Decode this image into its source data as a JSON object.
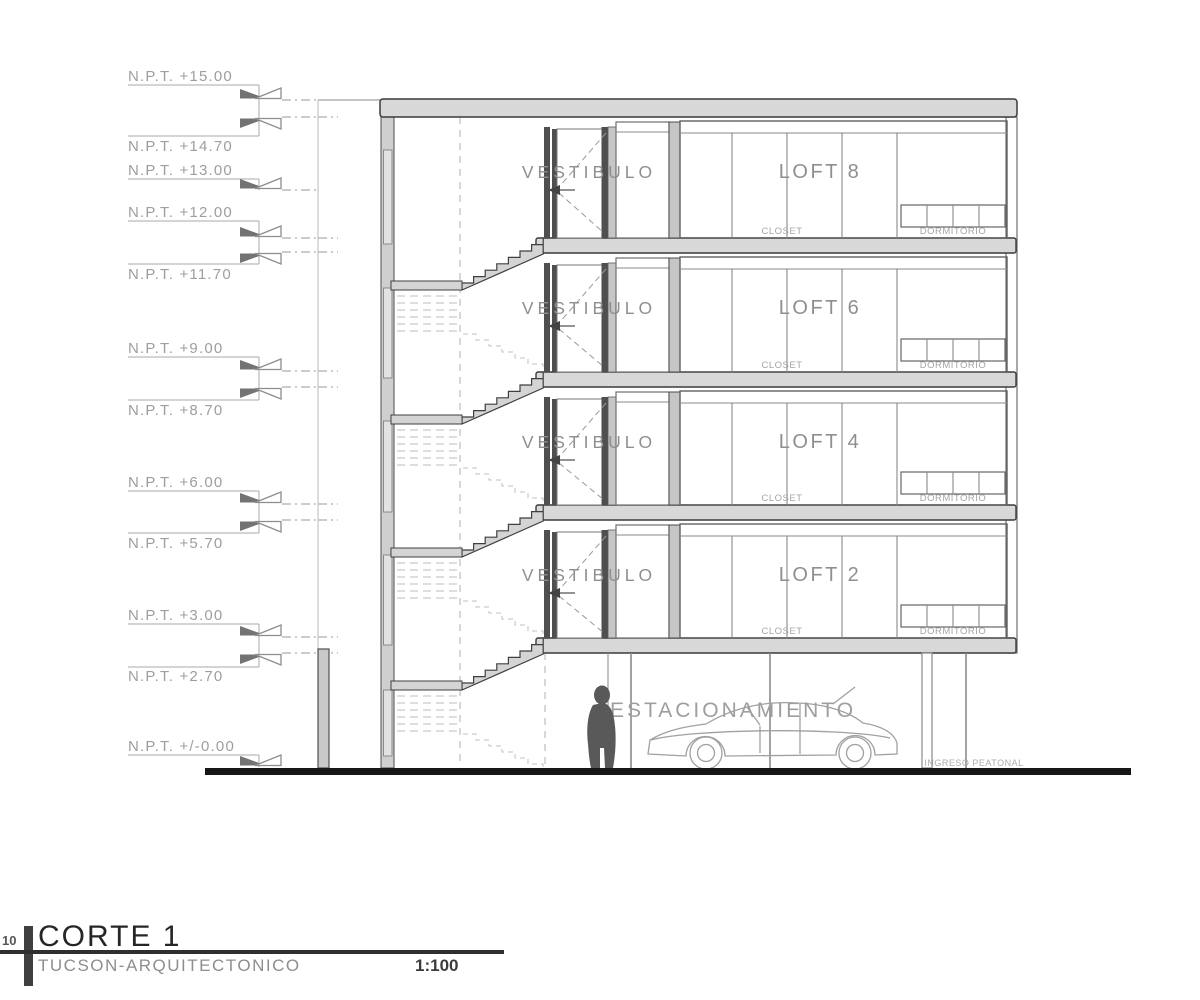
{
  "drawing": {
    "levels": [
      {
        "label": "N.P.T. +15.00"
      },
      {
        "label": "N.P.T. +14.70"
      },
      {
        "label": "N.P.T. +13.00"
      },
      {
        "label": "N.P.T. +12.00"
      },
      {
        "label": "N.P.T. +11.70"
      },
      {
        "label": "N.P.T. +9.00"
      },
      {
        "label": "N.P.T. +8.70"
      },
      {
        "label": "N.P.T. +6.00"
      },
      {
        "label": "N.P.T. +5.70"
      },
      {
        "label": "N.P.T. +3.00"
      },
      {
        "label": "N.P.T. +2.70"
      },
      {
        "label": "N.P.T. +/-0.00"
      }
    ],
    "floors": [
      {
        "vestibule": "VESTIBULO",
        "loft": "LOFT 8",
        "closet": "CLOSET",
        "bedroom": "DORMITORIO"
      },
      {
        "vestibule": "VESTIBULO",
        "loft": "LOFT 6",
        "closet": "CLOSET",
        "bedroom": "DORMITORIO"
      },
      {
        "vestibule": "VESTIBULO",
        "loft": "LOFT 4",
        "closet": "CLOSET",
        "bedroom": "DORMITORIO"
      },
      {
        "vestibule": "VESTIBULO",
        "loft": "LOFT 2",
        "closet": "CLOSET",
        "bedroom": "DORMITORIO"
      }
    ],
    "ground_floor": {
      "label": "ESTACIONAMIENTO",
      "entry_label": "INGRESO PEATONAL"
    }
  },
  "title_block": {
    "number": "10",
    "title": "CORTE 1",
    "subtitle": "TUCSON-ARQUITECTONICO",
    "scale": "1:100"
  },
  "colors": {
    "slab": "#d8d8d8",
    "wall": "#cfcfcf",
    "outline": "#3a3a3a",
    "annotation": "#9e9e9e",
    "ground": "#161616"
  }
}
